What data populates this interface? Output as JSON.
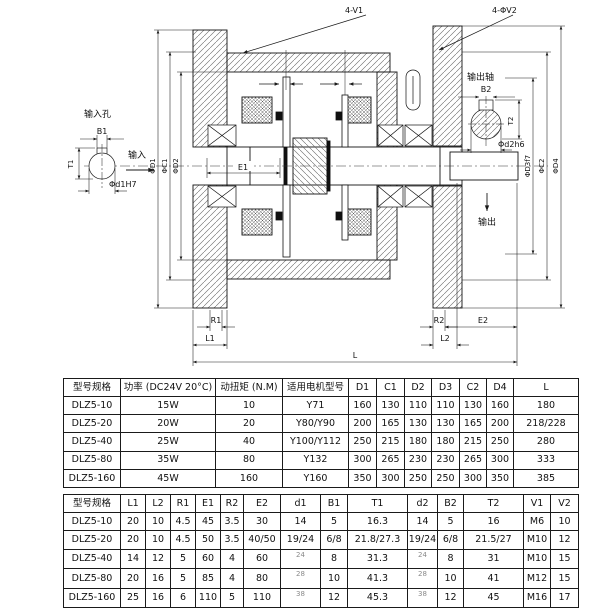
{
  "colors": {
    "line": "#1a1a1a",
    "background": "#ffffff"
  },
  "drawing": {
    "labels": {
      "v1": "4-V1",
      "v2": "4-ΦV2",
      "input_hole": "输入孔",
      "input": "输入",
      "b1": "B1",
      "t1": "T1",
      "d1h7": "Φd1H7",
      "dia_d1": "ΦD1",
      "dia_c1": "ΦC1",
      "dia_d2": "ΦD2",
      "e1": "E1",
      "output_shaft": "输出轴",
      "output": "输出",
      "b2": "B2",
      "t2": "T2",
      "d2h6": "Φd2h6",
      "dia_d3": "ΦD3f7",
      "dia_c2": "ΦC2",
      "dia_d4": "ΦD4",
      "r1": "R1",
      "l1": "L1",
      "r2": "R2",
      "e2": "E2",
      "l2": "L2",
      "l": "L"
    }
  },
  "table1": {
    "headers": [
      "型号规格",
      "功率 (DC24V 20°C)",
      "动扭矩 (N.M)",
      "适用电机型号",
      "D1",
      "C1",
      "D2",
      "D3",
      "C2",
      "D4",
      "L"
    ],
    "rows": [
      [
        "DLZ5-10",
        "15W",
        "10",
        "Y71",
        "160",
        "130",
        "110",
        "110",
        "130",
        "160",
        "180"
      ],
      [
        "DLZ5-20",
        "20W",
        "20",
        "Y80/Y90",
        "200",
        "165",
        "130",
        "130",
        "165",
        "200",
        "218/228"
      ],
      [
        "DLZ5-40",
        "25W",
        "40",
        "Y100/Y112",
        "250",
        "215",
        "180",
        "180",
        "215",
        "250",
        "280"
      ],
      [
        "DLZ5-80",
        "35W",
        "80",
        "Y132",
        "300",
        "265",
        "230",
        "230",
        "265",
        "300",
        "333"
      ],
      [
        "DLZ5-160",
        "45W",
        "160",
        "Y160",
        "350",
        "300",
        "250",
        "250",
        "300",
        "350",
        "385"
      ]
    ]
  },
  "table2": {
    "headers": [
      "型号规格",
      "L1",
      "L2",
      "R1",
      "E1",
      "R2",
      "E2",
      "d1",
      "B1",
      "T1",
      "d2",
      "B2",
      "T2",
      "V1",
      "V2"
    ],
    "rows": [
      [
        "DLZ5-10",
        "20",
        "10",
        "4.5",
        "45",
        "3.5",
        "30",
        "14",
        "5",
        "16.3",
        "14",
        "5",
        "16",
        "M6",
        "10"
      ],
      [
        "DLZ5-20",
        "20",
        "10",
        "4.5",
        "50",
        "3.5",
        "40/50",
        "19/24",
        "6/8",
        "21.8/27.3",
        "19/24",
        "6/8",
        "21.5/27",
        "M10",
        "12"
      ],
      [
        "DLZ5-40",
        "14",
        "12",
        "5",
        "60",
        "4",
        "60",
        "24",
        "8",
        "31.3",
        "24",
        "8",
        "31",
        "M10",
        "15"
      ],
      [
        "DLZ5-80",
        "20",
        "16",
        "5",
        "85",
        "4",
        "80",
        "28",
        "10",
        "41.3",
        "28",
        "10",
        "41",
        "M12",
        "15"
      ],
      [
        "DLZ5-160",
        "25",
        "16",
        "6",
        "110",
        "5",
        "110",
        "38",
        "12",
        "45.3",
        "38",
        "12",
        "45",
        "M16",
        "17"
      ]
    ],
    "small_cells": [
      [
        2,
        7
      ],
      [
        2,
        10
      ],
      [
        3,
        7
      ],
      [
        3,
        10
      ],
      [
        4,
        7
      ],
      [
        4,
        10
      ]
    ]
  }
}
